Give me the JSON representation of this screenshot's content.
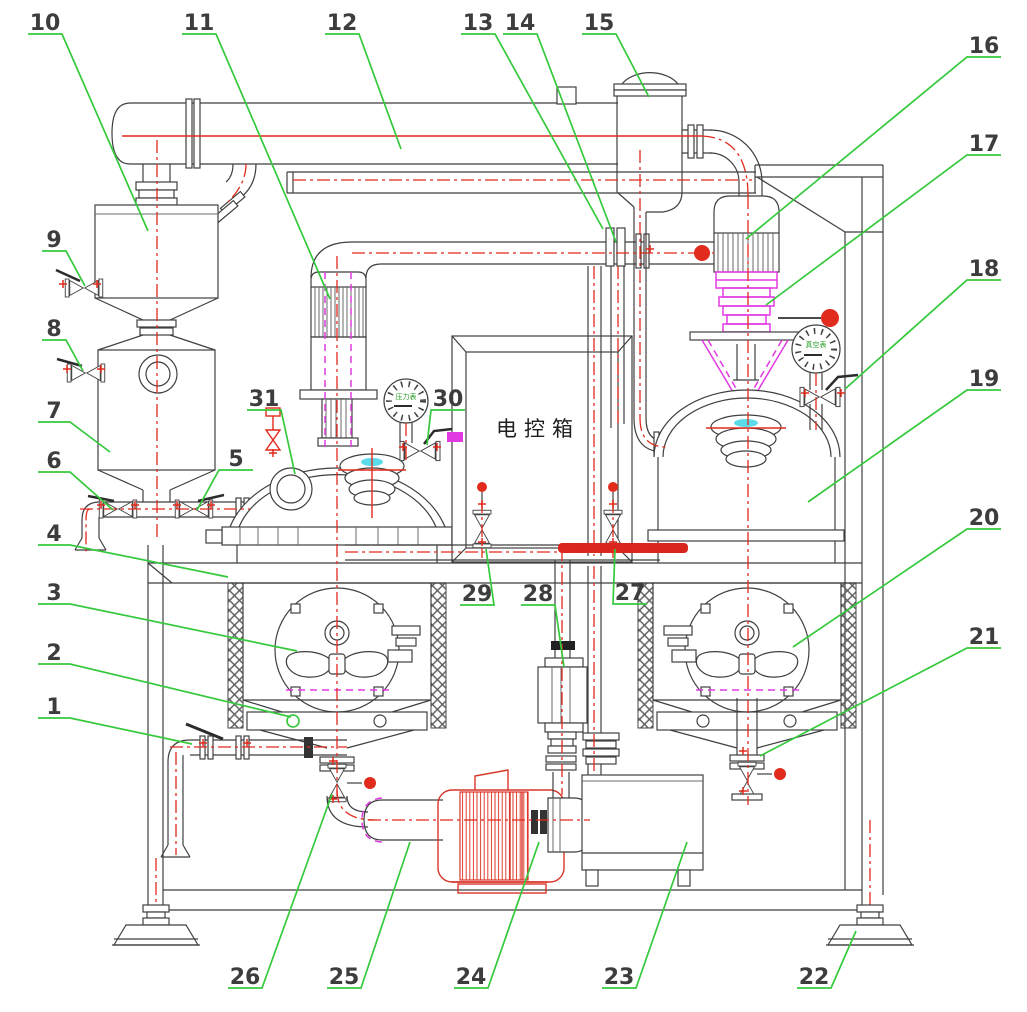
{
  "figure_labels": {
    "control_box": "电控箱",
    "pressure_gauge": "压力表",
    "vacuum_gauge": "真空表"
  },
  "callouts": [
    {
      "num": "1"
    },
    {
      "num": "2"
    },
    {
      "num": "3"
    },
    {
      "num": "4"
    },
    {
      "num": "5"
    },
    {
      "num": "6"
    },
    {
      "num": "7"
    },
    {
      "num": "8"
    },
    {
      "num": "9"
    },
    {
      "num": "10"
    },
    {
      "num": "11"
    },
    {
      "num": "12"
    },
    {
      "num": "13"
    },
    {
      "num": "14"
    },
    {
      "num": "15"
    },
    {
      "num": "16"
    },
    {
      "num": "17"
    },
    {
      "num": "18"
    },
    {
      "num": "19"
    },
    {
      "num": "20"
    },
    {
      "num": "21"
    },
    {
      "num": "22"
    },
    {
      "num": "23"
    },
    {
      "num": "24"
    },
    {
      "num": "25"
    },
    {
      "num": "26"
    },
    {
      "num": "27"
    },
    {
      "num": "28"
    },
    {
      "num": "29"
    },
    {
      "num": "30"
    },
    {
      "num": "31"
    }
  ],
  "colors": {
    "leader_green": "#35c93c",
    "centerline_red": "#e02b1d",
    "accent_magenta": "#e23ae2",
    "accent_cyan": "#49d7e8",
    "highlight_red": "#d9251d",
    "line_gray": "#3f3f3f"
  }
}
